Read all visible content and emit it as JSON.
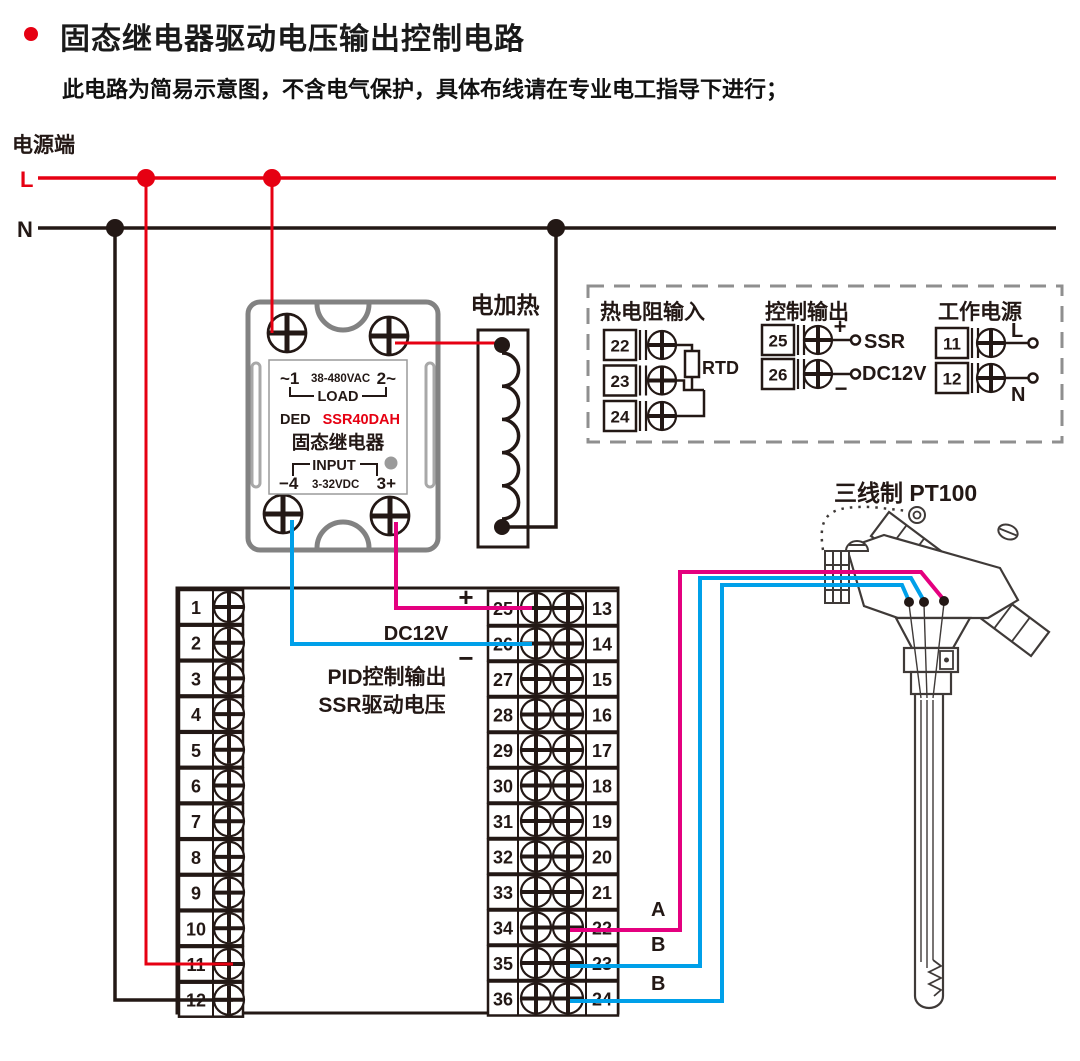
{
  "header": {
    "title": "固态继电器驱动电压输出控制电路",
    "subtitle": "此电路为简易示意图，不含电气保护，具体布线请在专业电工指导下进行；"
  },
  "power": {
    "label": "电源端",
    "l": "L",
    "n": "N"
  },
  "heater": {
    "label": "电加热"
  },
  "ssr": {
    "ac_left": "~1",
    "ac_rating": "38-480VAC",
    "ac_right": "2~",
    "load": "LOAD",
    "brand": "DED",
    "model": "SSR40DAH",
    "name": "固态继电器",
    "input": "INPUT",
    "dc_left": "−4",
    "dc_rating": "3-32VDC",
    "dc_right": "3+"
  },
  "legend": {
    "rtd": {
      "title": "热电阻输入",
      "terminals": [
        "22",
        "23",
        "24"
      ],
      "label": "RTD"
    },
    "ctrl": {
      "title": "控制输出",
      "terminals": [
        "25",
        "26"
      ],
      "plus": "+",
      "minus": "−",
      "ssr": "SSR",
      "dc12v": "DC12V"
    },
    "pwr": {
      "title": "工作电源",
      "terminals": [
        "11",
        "12"
      ],
      "l": "L",
      "n": "N"
    }
  },
  "probe": {
    "label": "三线制 PT100"
  },
  "block": {
    "left": [
      "1",
      "2",
      "3",
      "4",
      "5",
      "6",
      "7",
      "8",
      "9",
      "10",
      "11",
      "12"
    ],
    "mid": [
      "25",
      "26",
      "27",
      "28",
      "29",
      "30",
      "31",
      "32",
      "33",
      "34",
      "35",
      "36"
    ],
    "right": [
      "13",
      "14",
      "15",
      "16",
      "17",
      "18",
      "19",
      "20",
      "21",
      "22",
      "23",
      "24"
    ],
    "plus": "+",
    "minus": "−",
    "dc12v": "DC12V",
    "pid1": "PID控制输出",
    "pid2": "SSR驱动电压"
  },
  "wires": {
    "a": "A",
    "b1": "B",
    "b2": "B"
  },
  "colors": {
    "line_red": "#e60012",
    "wire_magenta": "#e4007f",
    "wire_cyan": "#00a0e9",
    "line_dark": "#231815",
    "casing_gray": "#828282",
    "model_red": "#e60012"
  }
}
